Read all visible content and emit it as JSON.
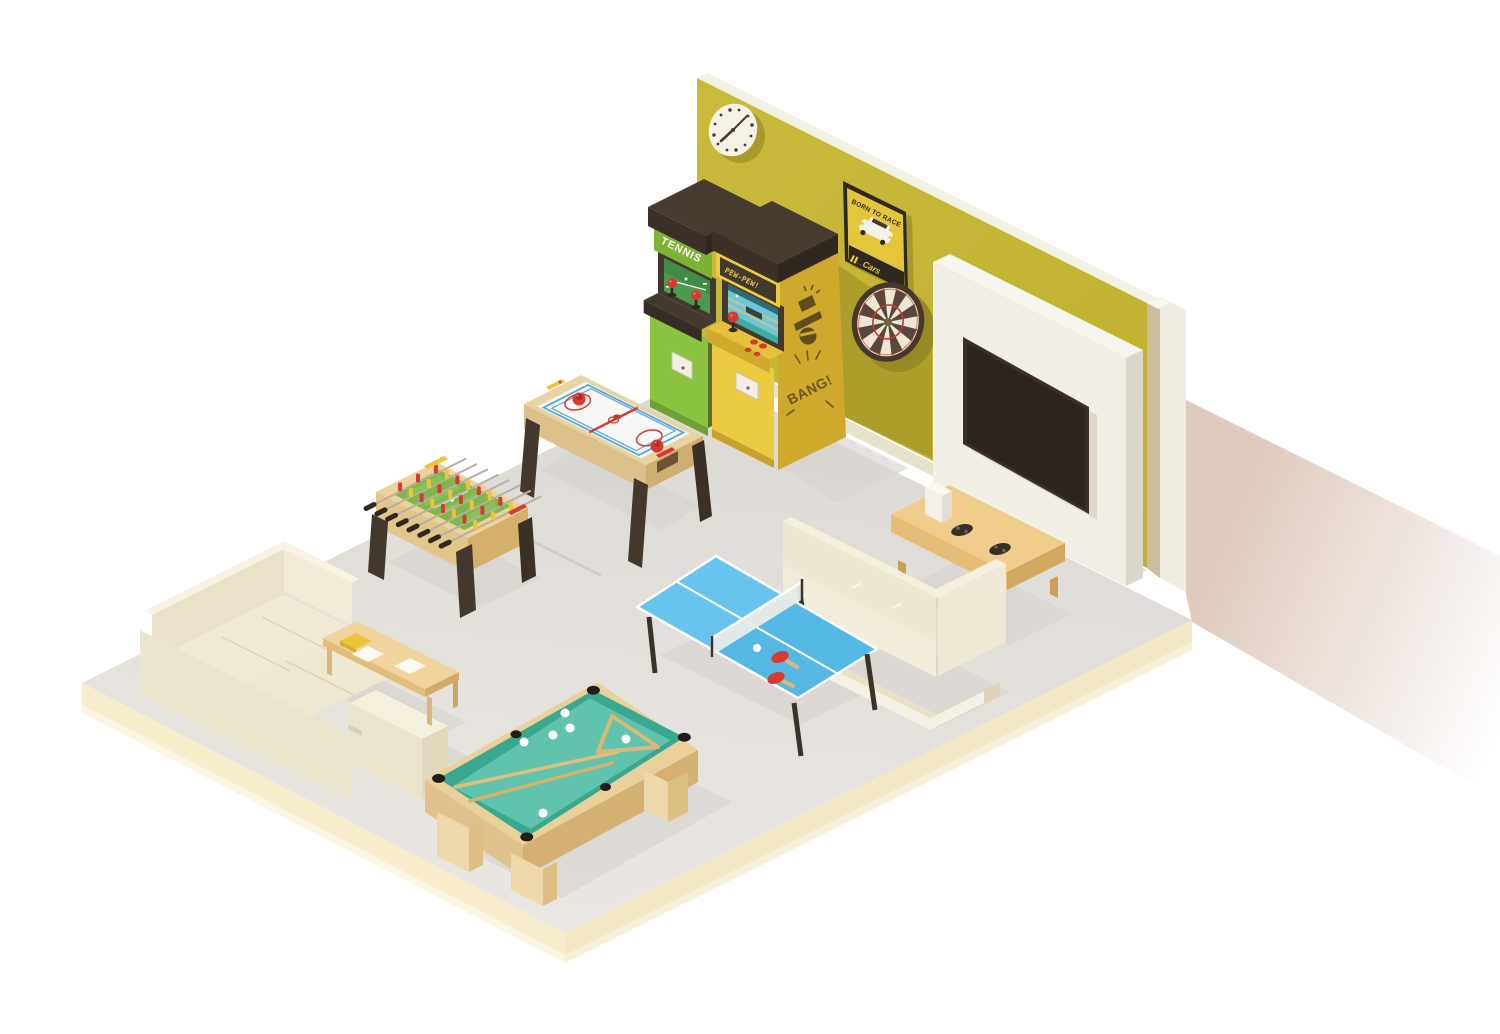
{
  "texts": {
    "tennis_marquee": "TENNIS",
    "shooter_marquee": "PEW-PEW!",
    "shooter_side_art": "BANG!",
    "poster_title": "BORN TO RACE",
    "poster_brand": "Cars"
  },
  "colors": {
    "wall_yellow": "#c4b534",
    "wall_shadow": "#a79a28",
    "floor_gray": "#e3e0db",
    "floor_edge_cream": "#f8eecd",
    "arcade_green": "#8bc340",
    "arcade_yellow": "#eccb42",
    "accent_red": "#d83a30",
    "pool_felt": "#5fc3ad",
    "pingpong_blue": "#55b8e4",
    "foosball_field": "#7cb84a",
    "wood_tan": "#ecd29b",
    "sofa_cream": "#efe9d4",
    "dark_brown": "#43382e",
    "cast_shadow_pink": "#d8c0b2",
    "tv_dark": "#362c24"
  },
  "objects": [
    "wall clock",
    "born-to-race poster",
    "dartboard",
    "tennis arcade cabinet",
    "pew-pew shooter arcade cabinet",
    "wall-mounted tv on white panel",
    "media console with game controllers and game console",
    "air hockey table",
    "foosball table",
    "table tennis table with paddles and ball",
    "pool table with cues, balls and rack",
    "corner sofa",
    "two-seat sofa",
    "coffee table with book and papers"
  ]
}
